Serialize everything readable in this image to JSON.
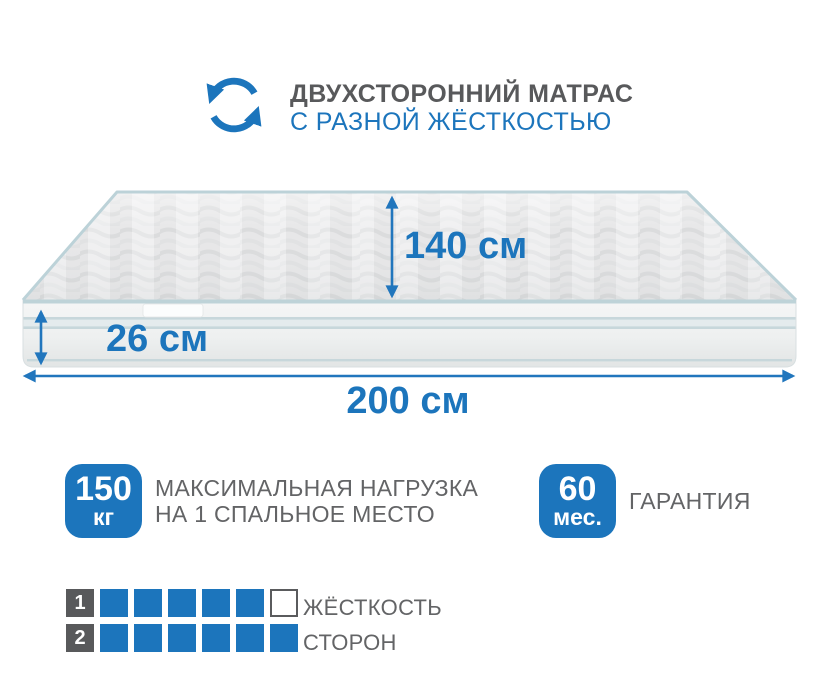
{
  "header": {
    "title": "ДВУХСТОРОННИЙ МАТРАС",
    "subtitle": "С РАЗНОЙ ЖЁСТКОСТЬЮ",
    "icon": "rotate-arrows-icon"
  },
  "colors": {
    "accent_blue": "#1C75BC",
    "text_gray": "#58595B",
    "caption_gray": "#636466",
    "piping_teal": "#BCD3D8"
  },
  "mattress": {
    "height_label": "140 см",
    "depth_label": "26 см",
    "width_label": "200 см"
  },
  "features": [
    {
      "badge_value": "150",
      "badge_unit": "кг",
      "label_line1": "МАКСИМАЛЬНАЯ НАГРУЗКА",
      "label_line2": "НА 1 СПАЛЬНОЕ МЕСТО"
    },
    {
      "badge_value": "60",
      "badge_unit": "мес.",
      "label_line1": "ГАРАНТИЯ",
      "label_line2": ""
    }
  ],
  "firmness": {
    "label_line1": "ЖЁСТКОСТЬ",
    "label_line2": "СТОРОН",
    "rows": [
      {
        "label": "1",
        "filled": 5,
        "total": 6
      },
      {
        "label": "2",
        "filled": 6,
        "total": 6
      }
    ]
  }
}
